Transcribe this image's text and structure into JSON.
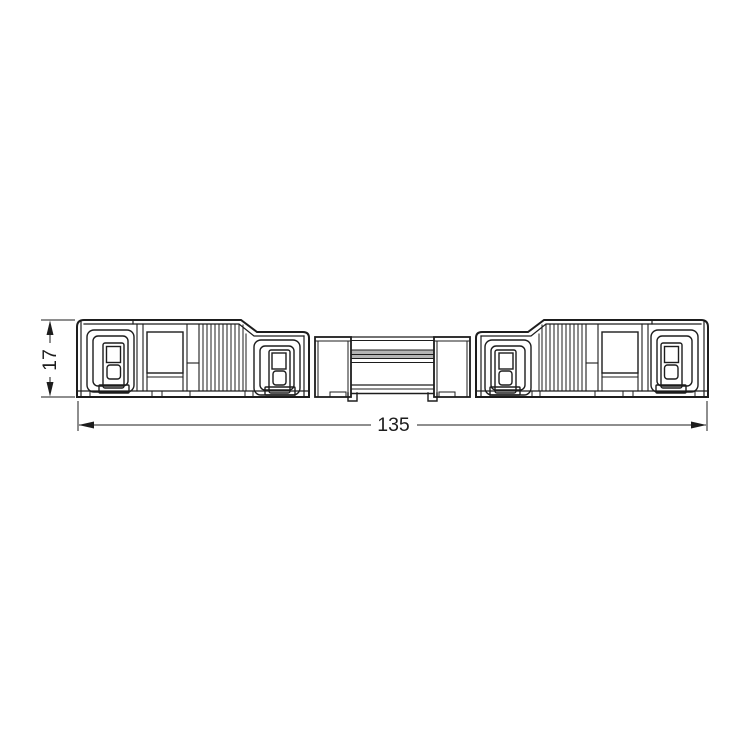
{
  "drawing": {
    "background_color": "#ffffff",
    "line_color": "#1d1d1d",
    "shading_color": "#b4b4b4",
    "dimensions": {
      "height_label": "17",
      "length_label": "135"
    }
  }
}
